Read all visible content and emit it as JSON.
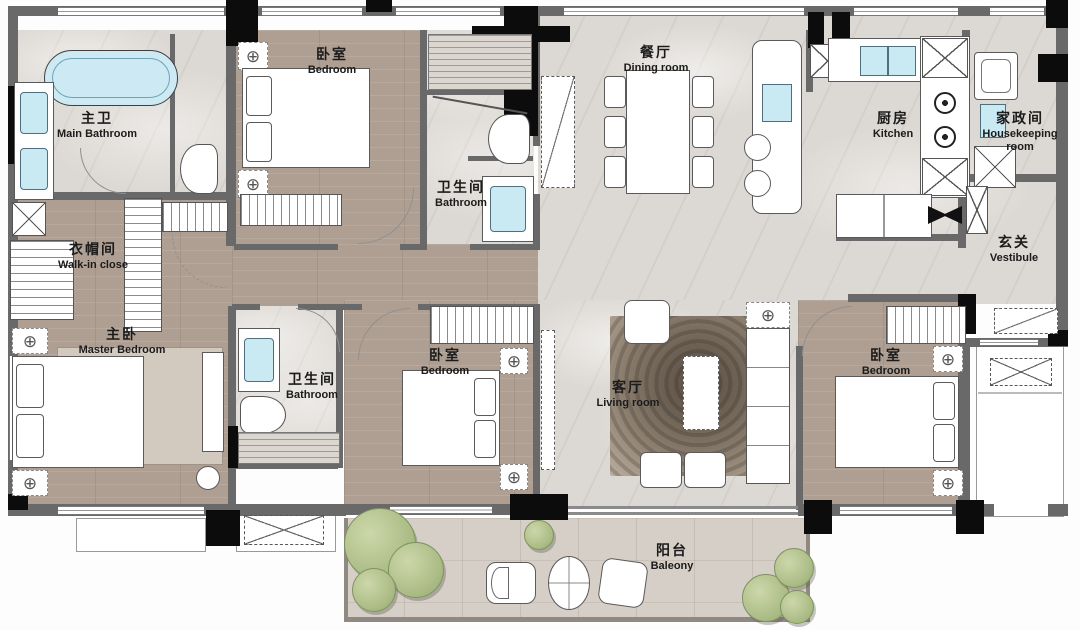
{
  "plan": {
    "rooms": {
      "main_bathroom": {
        "zh": "主卫",
        "en": "Main Bathroom"
      },
      "bedroom_top": {
        "zh": "卧室",
        "en": "Bedroom"
      },
      "bathroom_top": {
        "zh": "卫生间",
        "en": "Bathroom"
      },
      "dining_room": {
        "zh": "餐厅",
        "en": "Dining room"
      },
      "kitchen": {
        "zh": "厨房",
        "en": "Kitchen"
      },
      "housekeeping": {
        "zh": "家政间",
        "en": "Housekeeping room"
      },
      "vestibule": {
        "zh": "玄关",
        "en": "Vestibule"
      },
      "walk_in_closet": {
        "zh": "衣帽间",
        "en": "Walk-in close"
      },
      "master_bedroom": {
        "zh": "主卧",
        "en": "Master Bedroom"
      },
      "bathroom_mid": {
        "zh": "卫生间",
        "en": "Bathroom"
      },
      "bedroom_mid": {
        "zh": "卧室",
        "en": "Bedroom"
      },
      "living_room": {
        "zh": "客厅",
        "en": "Living room"
      },
      "bedroom_right": {
        "zh": "卧室",
        "en": "Bedroom"
      },
      "balcony": {
        "zh": "阳台",
        "en": "Baleony"
      }
    },
    "colors": {
      "wood_floor": "#ae9f92",
      "marble_floor": "#dcd8d3",
      "wall": "#696969",
      "column": "#0c0c0c",
      "water_fixture": "#c9e9f3",
      "plant_green": "#abbc86",
      "living_rug": "#6d6154"
    }
  }
}
